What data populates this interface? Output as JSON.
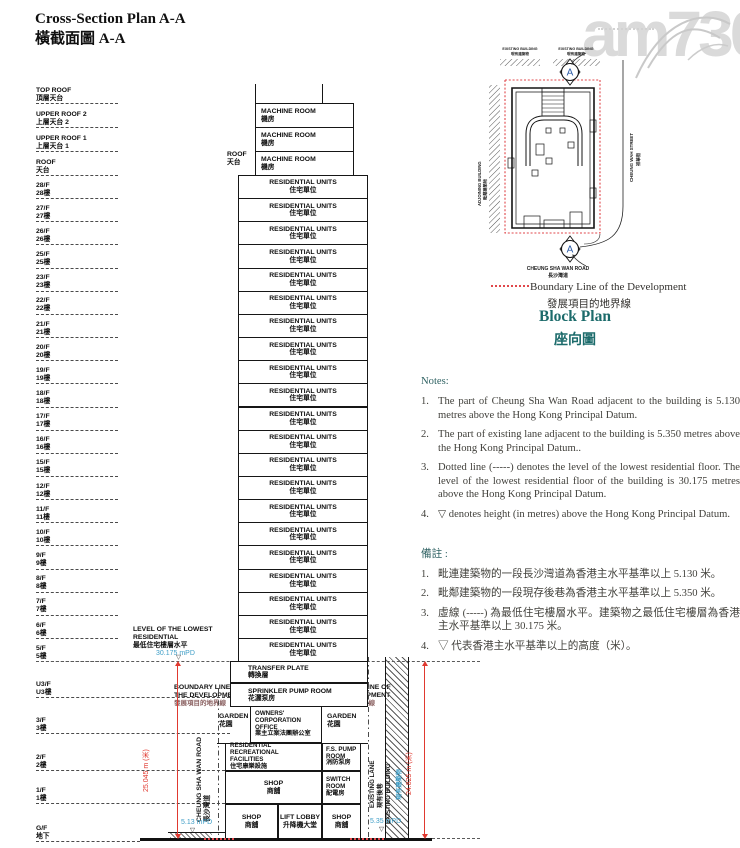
{
  "title": {
    "en": "Cross-Section Plan A-A",
    "zh": "橫截面圖 A-A"
  },
  "watermark": "am730",
  "floors_upper": [
    {
      "en": "TOP ROOF",
      "zh": "頂層天台"
    },
    {
      "en": "UPPER ROOF 2",
      "zh": "上層天台 2"
    },
    {
      "en": "UPPER ROOF 1",
      "zh": "上層天台 1"
    },
    {
      "en": "ROOF",
      "zh": "天台"
    },
    {
      "en": "28/F",
      "zh": "28樓"
    },
    {
      "en": "27/F",
      "zh": "27樓"
    },
    {
      "en": "26/F",
      "zh": "26樓"
    },
    {
      "en": "25/F",
      "zh": "25樓"
    },
    {
      "en": "23/F",
      "zh": "23樓"
    },
    {
      "en": "22/F",
      "zh": "22樓"
    },
    {
      "en": "21/F",
      "zh": "21樓"
    },
    {
      "en": "20/F",
      "zh": "20樓"
    },
    {
      "en": "19/F",
      "zh": "19樓"
    },
    {
      "en": "18/F",
      "zh": "18樓"
    },
    {
      "en": "17/F",
      "zh": "17樓"
    },
    {
      "en": "16/F",
      "zh": "16樓"
    },
    {
      "en": "15/F",
      "zh": "15樓"
    },
    {
      "en": "12/F",
      "zh": "12樓"
    },
    {
      "en": "11/F",
      "zh": "11樓"
    },
    {
      "en": "10/F",
      "zh": "10樓"
    },
    {
      "en": "9/F",
      "zh": "9樓"
    },
    {
      "en": "8/F",
      "zh": "8樓"
    },
    {
      "en": "7/F",
      "zh": "7樓"
    },
    {
      "en": "6/F",
      "zh": "6樓"
    },
    {
      "en": "5/F",
      "zh": "5樓"
    }
  ],
  "floors_lower": [
    {
      "en": "U3/F",
      "zh": "U3樓"
    },
    {
      "en": "3/F",
      "zh": "3樓"
    },
    {
      "en": "2/F",
      "zh": "2樓"
    },
    {
      "en": "1/F",
      "zh": "1樓"
    },
    {
      "en": "G/F",
      "zh": "地下"
    }
  ],
  "tower": {
    "machine_room": {
      "en": "MACHINE ROOM",
      "zh": "機房"
    },
    "machine_count": 3,
    "residential": {
      "en": "RESIDENTIAL UNITS",
      "zh": "住宅單位"
    },
    "residential_count": 21,
    "roof_side_label": {
      "en": "ROOF",
      "zh": "天台"
    },
    "transfer_plate": {
      "en": "TRANSFER PLATE",
      "zh": "轉換層"
    },
    "sprinkler_pump_room": {
      "en": "SPRINKLER PUMP ROOM",
      "zh": "花灑泵房"
    },
    "owners_office": {
      "en1": "OWNERS'",
      "en2": "CORPORATION",
      "en3": "OFFICE",
      "zh": "業主立案法團辦公室"
    },
    "garden": {
      "en": "GARDEN",
      "zh": "花園"
    },
    "recreational": {
      "en1": "RESIDENTIAL RECREATIONAL",
      "en2": "FACILITIES",
      "zh": "住宅康樂設施"
    },
    "fs_pump_room": {
      "en1": "F.S. PUMP",
      "en2": "ROOM",
      "zh": "消防泵房"
    },
    "switch_room": {
      "en1": "SWITCH",
      "en2": "ROOM",
      "zh": "配電房"
    },
    "shop": {
      "en": "SHOP",
      "zh": "商舖"
    },
    "lift_lobby": {
      "en": "LIFT LOBBY",
      "zh": "升降機大堂"
    }
  },
  "annotations": {
    "lowest_level": {
      "en1": "LEVEL OF THE LOWEST",
      "en2": "RESIDENTIAL",
      "zh": "最低住宅樓層水平",
      "value": "30.175 mPD"
    },
    "boundary": {
      "en1": "BOUNDARY LINE OF",
      "en2": "THE DEVELOPMENT",
      "zh": "發展項目的地界線"
    },
    "road": {
      "en": "CHEUNG SHA WAN ROAD",
      "zh": "長沙灣道",
      "level": "5.13 mPD"
    },
    "lane": {
      "en": "EXISTING LANE",
      "zh": "現有後巷",
      "level": "5.35 mPD"
    },
    "existing_building": {
      "en": "EXISTING BUILDING",
      "zh": "現有建築物"
    },
    "dim_left": "25.045 m (米)",
    "dim_right": "24.825 m (米)",
    "level_marker": "▽"
  },
  "block_plan": {
    "marker": "A",
    "adjoining": {
      "en": "ADJOINING BUILDING",
      "zh": "毗鄰建築物"
    },
    "street": {
      "en": "CHEUNG WAH STREET",
      "zh": "祥華街"
    },
    "road": {
      "en": "CHEUNG SHA WAN ROAD",
      "zh": "長沙灣道"
    },
    "existing_building": {
      "en": "EXISTING BUILDING",
      "zh": "現有建築物"
    },
    "legend": {
      "en": "Boundary Line of the Development",
      "zh": "發展項目的地界線"
    },
    "title_en": "Block Plan",
    "title_zh": "座向圖"
  },
  "notes": {
    "heading_en": "Notes:",
    "items_en": [
      "The part of Cheung Sha Wan Road adjacent to the building is 5.130 metres above the Hong Kong Principal Datum.",
      "The part of existing lane adjacent to the building is 5.350 metres above the Hong Kong Principal Datum..",
      "Dotted line (-----) denotes the level of the lowest residential floor. The level of the lowest residential floor of the building is 30.175 metres above the Hong Kong Principal Datum.",
      "▽ denotes height (in metres) above the Hong Kong Principal Datum."
    ],
    "heading_zh": "備註 :",
    "items_zh": [
      "毗連建築物的一段長沙灣道為香港主水平基準以上 5.130 米。",
      "毗鄰建築物的一段現存後巷為香港主水平基準以上 5.350 米。",
      "虛線 (-----) 為最低住宅樓層水平。建築物之最低住宅樓層為香港主水平基準以上 30.175 米。",
      "▽ 代表香港主水平基準以上的高度（米）。"
    ]
  },
  "colors": {
    "heading_teal": "#1c6b6b",
    "notes_teal": "#2f6263",
    "dimension_red": "#e0392f",
    "boundary_red": "#e0474b",
    "level_blue": "#3f9ec7",
    "ink": "#161616",
    "watermark_gray": "#dadada"
  }
}
